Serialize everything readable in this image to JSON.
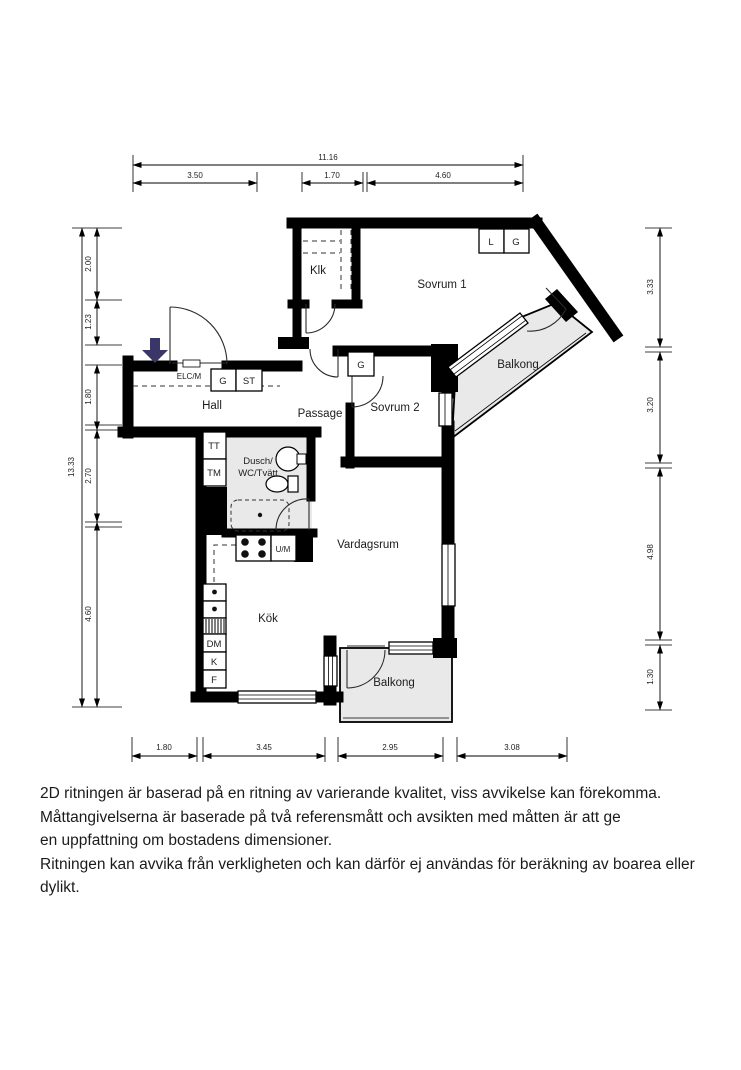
{
  "plan": {
    "rooms": {
      "klk": "Klk",
      "sovrum1": "Sovrum 1",
      "sovrum2": "Sovrum 2",
      "balkong_upper": "Balkong",
      "hall": "Hall",
      "passage": "Passage",
      "bathroom_line1": "Dusch/",
      "bathroom_line2": "WC/Tvätt",
      "vardagsrum": "Vardagsrum",
      "kok": "Kök",
      "balkong_lower": "Balkong"
    },
    "fixtures": {
      "elcm": "ELC/M",
      "g_hall": "G",
      "st_hall": "ST",
      "l_sovrum1": "L",
      "g_sovrum1": "G",
      "g_sovrum2": "G",
      "um": "U/M",
      "dm": "DM",
      "k": "K",
      "f": "F",
      "tt": "TT",
      "tm": "TM"
    },
    "dimensions": {
      "top_total": "11.16",
      "top": [
        "3.50",
        "1.70",
        "4.60"
      ],
      "left_total": "13.33",
      "left": [
        "2.00",
        "1.23",
        "1.80",
        "2.70",
        "4.60"
      ],
      "right": [
        "3.33",
        "3.20",
        "4.98",
        "1.30"
      ],
      "bottom": [
        "1.80",
        "3.45",
        "2.95",
        "3.08"
      ]
    }
  },
  "colors": {
    "wall": "#000000",
    "room_gray": "#e9e9e9",
    "arrow": "#3b3668"
  },
  "disclaimer": {
    "lines": [
      "2D ritningen är baserad på en ritning av varierande kvalitet, viss avvikelse kan förekomma.",
      "Måttangivelserna är baserade på två referensmått och avsikten med måtten är att ge",
      "en uppfattning om bostadens dimensioner.",
      "Ritningen kan avvika från verkligheten och kan därför ej användas för beräkning av boarea eller dylikt."
    ]
  }
}
